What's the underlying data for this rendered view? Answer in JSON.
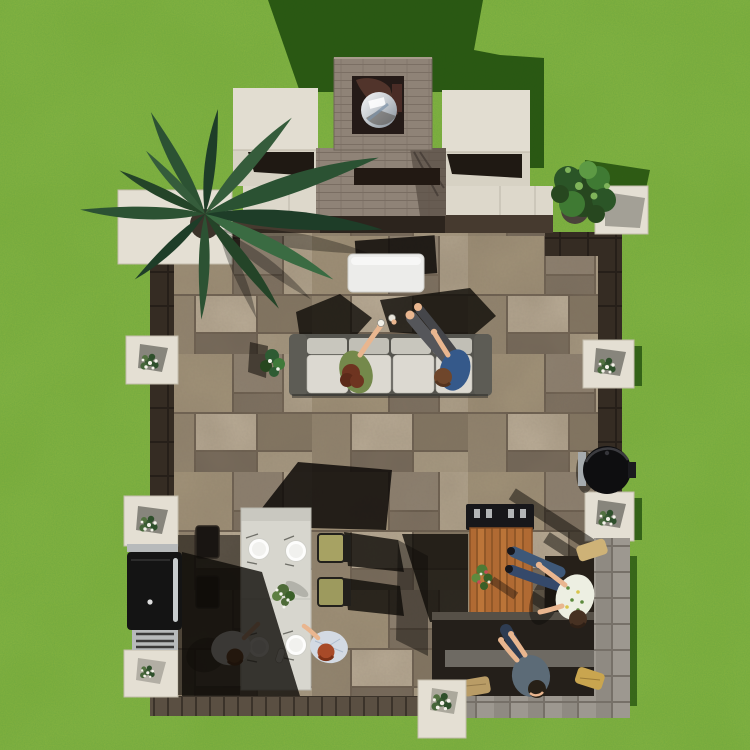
{
  "scene": {
    "description": "Aerial top-down view of a backyard paver patio on a green lawn: outdoor fireplace with stainless flue cap at top, sectional sofa with two people toasting, white ottoman, palm and shrub corner planters, white pillar caps with flowers, long outdoor dining table with plates and four people, black grill on the left edge, wood bar table with bouquet, kamado grill, and an L-shaped stone bench with seated people and pillows at the lower right, strong sunlight casting shadows up and to the right",
    "areas": [
      {
        "name": "lawn"
      },
      {
        "name": "outdoor-fireplace"
      },
      {
        "name": "paver-patio-floor"
      },
      {
        "name": "lounge-sofa-area"
      },
      {
        "name": "dining-table-area"
      },
      {
        "name": "grill-station"
      },
      {
        "name": "bar-and-bench-area"
      },
      {
        "name": "corner-planters"
      }
    ],
    "people_count": 6
  },
  "colors": {
    "grass": "#81af3c",
    "grassShadow": "#23500f",
    "cap": "#e4dfd3",
    "capEdge": "#c3bdac",
    "wallDark": "#31281f",
    "chimney": "#8f8377",
    "cushion": "#dcd9d1",
    "sofaFrame": "#55544e",
    "wood": "#b06a33",
    "tableTop": "#d7d6ce",
    "skin": "#e9b68f",
    "denim": "#3c5574",
    "steel": "#c9ced3",
    "paverJoint": "#66594b",
    "oliveCushion": "#a7a263",
    "pillowTan": "#c0a369",
    "firebrick": "#57372e"
  }
}
